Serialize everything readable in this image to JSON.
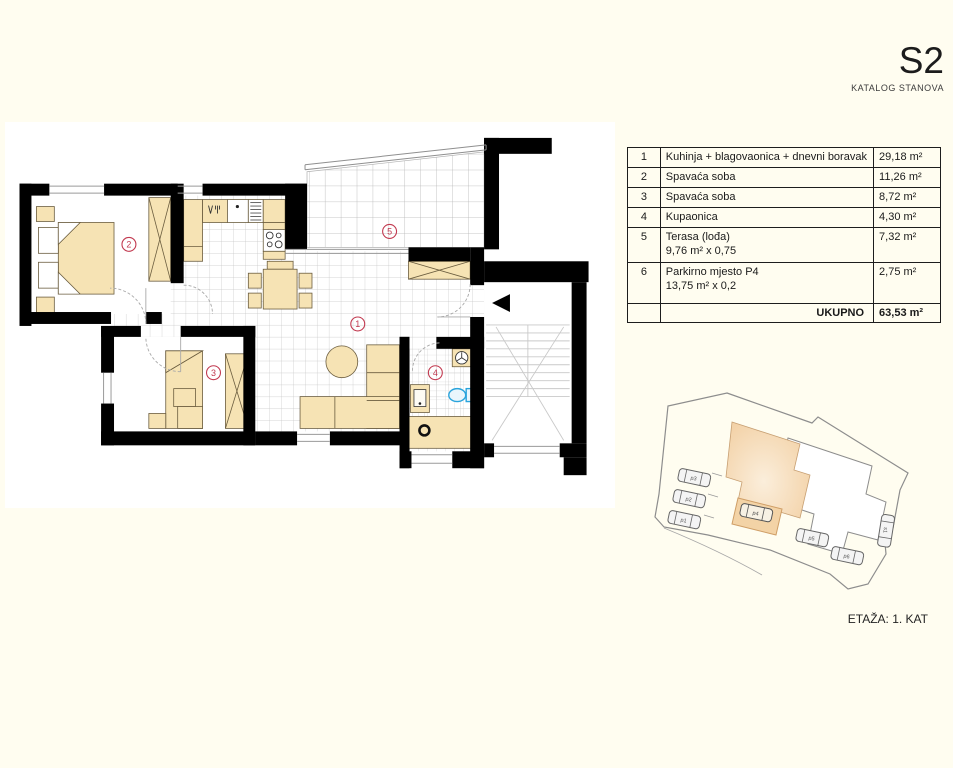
{
  "header": {
    "title": "S2",
    "subtitle": "KATALOG STANOVA"
  },
  "footer": {
    "floor_label": "ETAŽA: 1. KAT"
  },
  "table": {
    "rows": [
      {
        "num": "1",
        "name": "Kuhinja + blagovaonica + dnevni boravak",
        "name2": "",
        "area": "29,18  m²"
      },
      {
        "num": "2",
        "name": "Spavaća soba",
        "name2": "",
        "area": "11,26 m²"
      },
      {
        "num": "3",
        "name": "Spavaća soba",
        "name2": "",
        "area": "8,72 m²"
      },
      {
        "num": "4",
        "name": "Kupaonica",
        "name2": "",
        "area": "4,30 m²"
      },
      {
        "num": "5",
        "name": "Terasa (lođa)",
        "name2": "9,76 m² x 0,75",
        "area": "7,32 m²"
      },
      {
        "num": "6",
        "name": "Parkirno mjesto P4",
        "name2": "13,75 m² x 0,2",
        "area": "2,75 m²"
      }
    ],
    "total_label": "UKUPNO",
    "total_area": "63,53 m²"
  },
  "floorplan": {
    "room_labels": [
      "1",
      "2",
      "3",
      "4",
      "5"
    ],
    "label_color": "#c23a50",
    "furniture_color": "#f6e3b4",
    "wall_color": "#000000",
    "toilet_color": "#2aa4dc"
  },
  "siteplan": {
    "car_labels": [
      "p1",
      "p2",
      "p3",
      "p4",
      "p5",
      "p6",
      "s1"
    ],
    "highlight_color": "#f5d9b5"
  }
}
